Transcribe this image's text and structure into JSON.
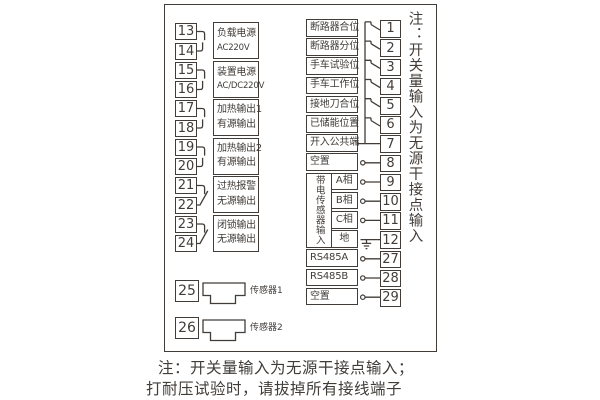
{
  "left": {
    "pairs": [
      {
        "a": "13",
        "b": "14",
        "line1": "负载电源",
        "line2": "AC220V"
      },
      {
        "a": "15",
        "b": "16",
        "line1": "装置电源",
        "line2": "AC/DC220V"
      },
      {
        "a": "17",
        "b": "18",
        "line1": "加热输出1",
        "line2": "有源输出"
      },
      {
        "a": "19",
        "b": "20",
        "line1": "加热输出2",
        "line2": "有源输出"
      },
      {
        "a": "21",
        "b": "22",
        "line1": "过热报警",
        "line2": "无源输出"
      },
      {
        "a": "23",
        "b": "24",
        "line1": "闭锁输出",
        "line2": "无源输出"
      }
    ],
    "sensors": [
      {
        "terminal": "25",
        "label": "传感器1"
      },
      {
        "terminal": "26",
        "label": "传感器2"
      }
    ]
  },
  "right": {
    "rows": [
      {
        "label": "断路器合位",
        "terminal": "1"
      },
      {
        "label": "断路器分位",
        "terminal": "2"
      },
      {
        "label": "手车试验位",
        "terminal": "3"
      },
      {
        "label": "手车工作位",
        "terminal": "4"
      },
      {
        "label": "接地刀合位",
        "terminal": "5"
      },
      {
        "label": "已储能位置",
        "terminal": "6"
      },
      {
        "label": "开入公共端",
        "terminal": "7"
      },
      {
        "label": "空置",
        "terminal": "8"
      }
    ],
    "sensor_group": {
      "label": "带电传感器输入",
      "subs": [
        {
          "label": "A相",
          "terminal": "9"
        },
        {
          "label": "B相",
          "terminal": "10"
        },
        {
          "label": "C相",
          "terminal": "11"
        },
        {
          "label": "地",
          "terminal": "12"
        }
      ]
    },
    "comm_rows": [
      {
        "label": "RS485A",
        "terminal": "27"
      },
      {
        "label": "RS485B",
        "terminal": "28"
      },
      {
        "label": "空置",
        "terminal": "29"
      }
    ],
    "side_note": "注：开关量输入为无源干接点输入"
  },
  "notes": {
    "line1": "注：开关量输入为无源干接点输入；",
    "line2": "打耐压试验时，请拔掉所有接线端子"
  },
  "colors": {
    "ink": "#413c38",
    "background": "#ffffff"
  }
}
